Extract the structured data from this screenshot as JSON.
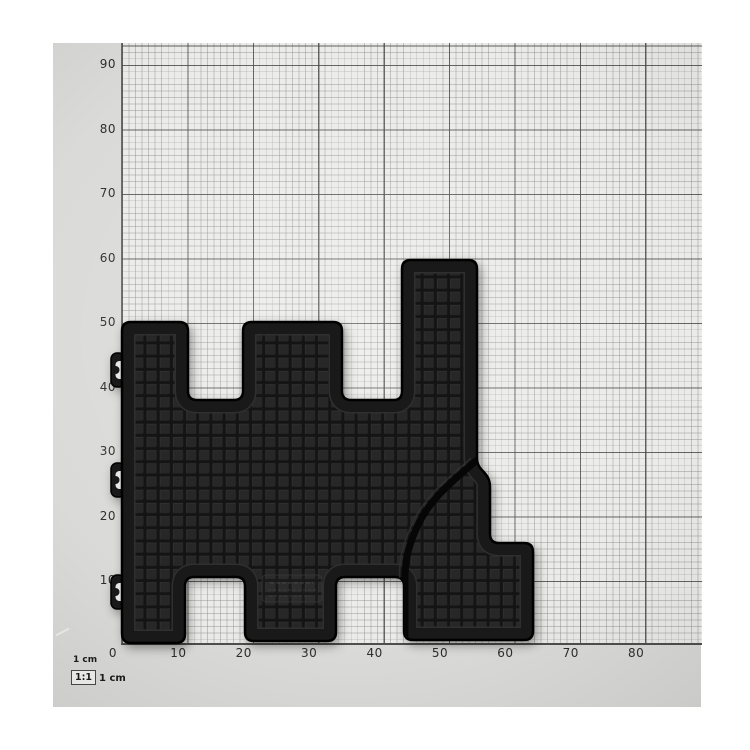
{
  "subject": {
    "description": "Black rubber car floor mat photographed flat on a 1 cm measuring grid board",
    "scale_ratio": "1:1",
    "approx_width_cm": 63,
    "approx_height_cm": 59
  },
  "axes": {
    "unit": "cm",
    "left_labels": [
      "90",
      "80",
      "70",
      "60",
      "50",
      "40",
      "30",
      "20",
      "10"
    ],
    "bottom_labels": [
      "0",
      "10",
      "20",
      "30",
      "40",
      "50",
      "60",
      "70",
      "80"
    ]
  },
  "scale_legend": {
    "top_label": "1 cm",
    "ratio": "1:1",
    "side_label": "1 cm"
  },
  "colors": {
    "mat": "#1d1d1d",
    "mat_square": "#272727",
    "paper": "#ebebe9",
    "board_margin": "#dadad8",
    "grid_minor": "#8c8c8a",
    "grid_major": "#464644",
    "label_text": "#2e2e2c"
  }
}
